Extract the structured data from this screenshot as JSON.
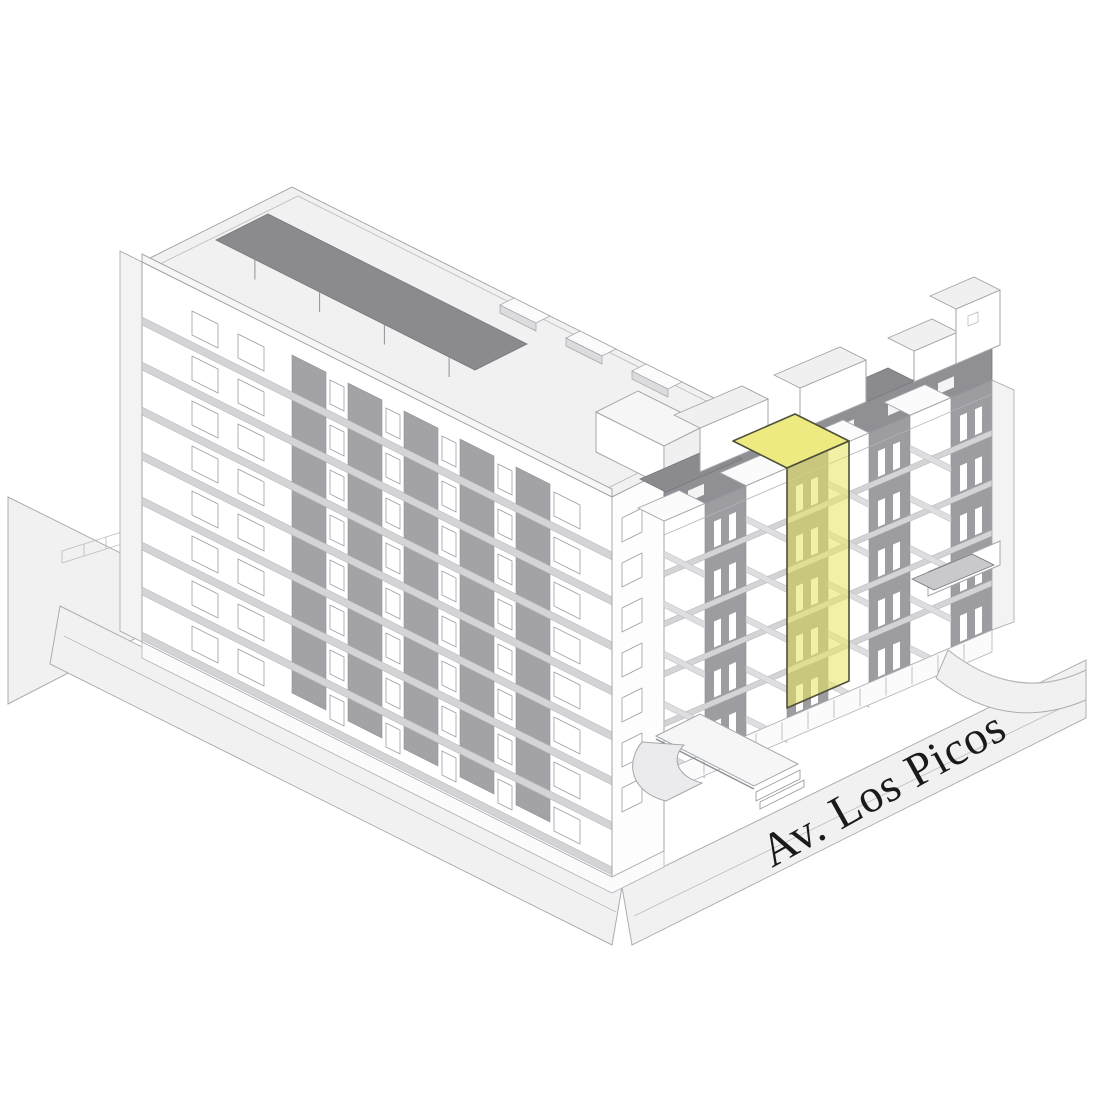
{
  "street_label": {
    "text": "Av. Los Picos"
  },
  "palette": {
    "background": "#ffffff",
    "highlight_fill": "#e8e365",
    "highlight_top": "#eeea82",
    "highlight_outline": "#50503a",
    "facade_strip_gray": "#a3a3a7",
    "recess_gray": "#9d9da1",
    "pergola_gray": "#8b8b8f",
    "attic_gray": "#909094",
    "floor_band_gray": "#d4d4d6",
    "inner_band_gray": "#dedee0",
    "deck_gray": "#c9c9cb",
    "ground_gray": "#f1f1f2",
    "line_gray": "#a2a6aa",
    "window_frame_gray": "#9aa0a4",
    "label_color": "#1a1a18"
  },
  "buildings": {
    "left_wing": {
      "name": "left-wing",
      "floors": 8,
      "window_strips": 5
    },
    "right_wing": {
      "name": "right-wing",
      "floors": 5,
      "white_bays": 4,
      "gray_bays": 4
    },
    "highlighted_unit": {
      "name": "highlighted-unit"
    }
  }
}
